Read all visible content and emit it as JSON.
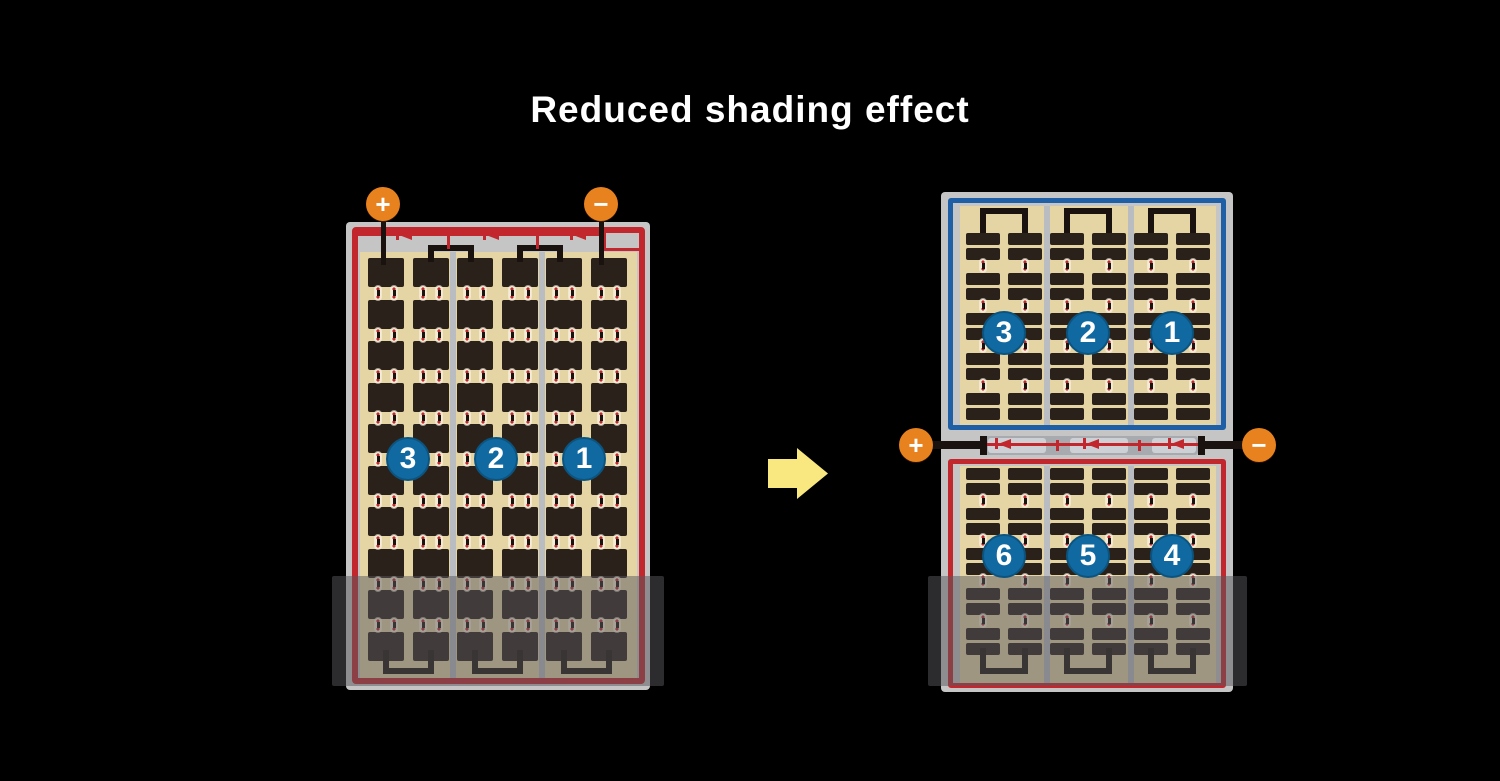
{
  "title": "Reduced shading effect",
  "colors": {
    "background": "#000000",
    "panel_frame": "#C5C5C5",
    "cell_dark": "#2B211B",
    "cell_field_tan": "#E5D4A4",
    "divider_gray": "#B9BDC2",
    "wire_black": "#1A120E",
    "circuit_red": "#C1272D",
    "border_blue": "#1E5FA5",
    "terminal_orange": "#E8821E",
    "string_circle_blue": "#1069A0",
    "shade_overlay": "rgba(88,88,92,0.5)",
    "arrow_yellow": "#F9E87F",
    "connector_cream": "#F4ECD6",
    "junction_strip_gray": "#A7AAAE",
    "junction_block_gray": "#CDD0D4"
  },
  "terminals": {
    "plus": "+",
    "minus": "−"
  },
  "left_panel": {
    "strings": [
      "3",
      "2",
      "1"
    ]
  },
  "right_panel": {
    "top_strings": [
      "3",
      "2",
      "1"
    ],
    "bottom_strings": [
      "6",
      "5",
      "4"
    ]
  }
}
